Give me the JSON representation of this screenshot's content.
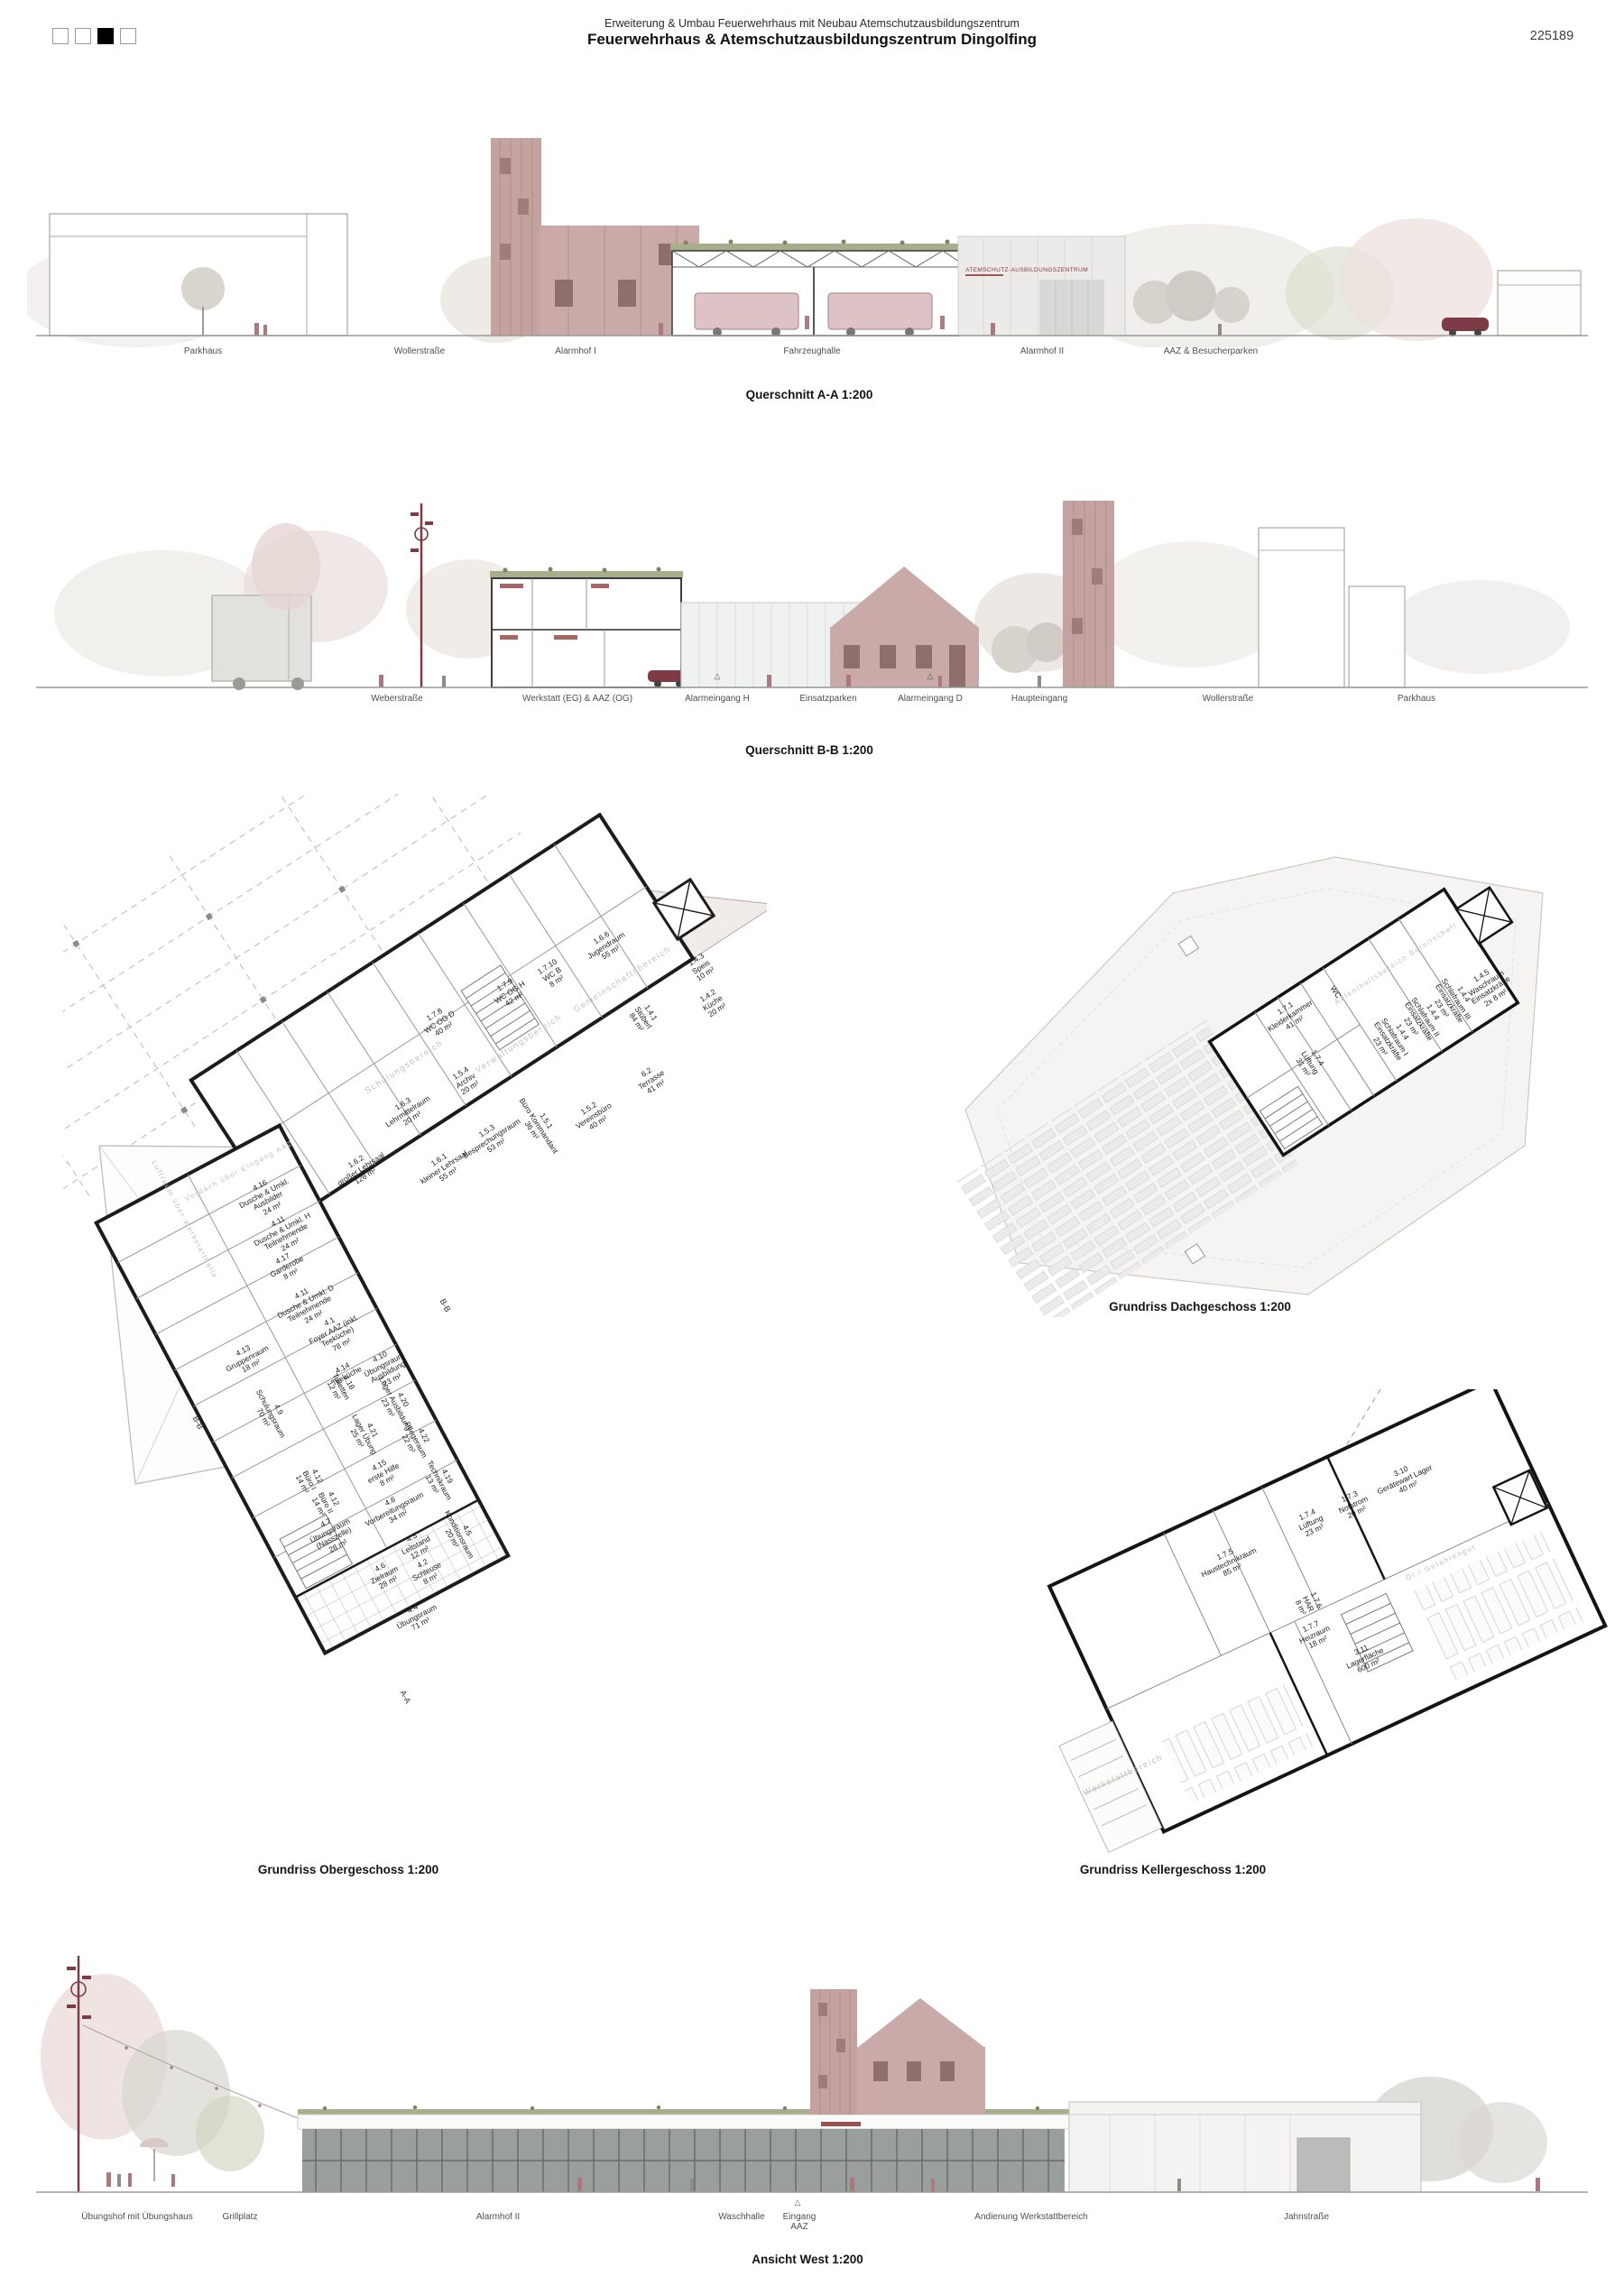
{
  "header": {
    "project_line": "Erweiterung & Umbau Feuerwehrhaus mit Neubau Atemschutzausbildungszentrum",
    "title": "Feuerwehrhaus & Atemschutzausbildungszentrum Dingolfing",
    "sheet_number": "225189",
    "page_indicator": {
      "count": 4,
      "active_index": 3
    }
  },
  "colors": {
    "rose_facade": "#c5a5a3",
    "rose_building": "#c9aaa8",
    "sign_red": "#8a3233",
    "car_red": "#7d3c45",
    "tree_gray": "#d6d3cd",
    "tree_green": "#cfd4c0",
    "wall_black": "#1c1c1c"
  },
  "section_aa": {
    "caption": "Querschnitt A-A 1:200",
    "facade_sign": "ATEMSCHUTZ-AUSBILDUNGSZENTRUM",
    "ground_labels": [
      "Parkhaus",
      "Wollerstraße",
      "Alarmhof I",
      "Fahrzeughalle",
      "Alarmhof II",
      "AAZ & Besucherparken"
    ]
  },
  "section_bb": {
    "caption": "Querschnitt B-B 1:200",
    "ground_labels": [
      "Weberstraße",
      "Werkstatt (EG) & AAZ (OG)",
      "Alarmeingang H",
      "Einsatzparken",
      "Alarmeingang D",
      "Haupteingang",
      "Wollerstraße",
      "Parkhaus"
    ]
  },
  "plan_og": {
    "caption": "Grundriss Obergeschoss 1:200",
    "zones": [
      "Gemeinschaftsbereich",
      "Verwaltungsbereich",
      "Schulungsbereich",
      "Vordach über Eingang AAZ",
      "Luftraum über Werkstatthalle"
    ],
    "markers": {
      "bb": "B-B",
      "aa": "A-A"
    },
    "rooms": [
      {
        "num": "1.6.6",
        "name": "Jugendraum",
        "area": "55 m²"
      },
      {
        "num": "1.7.9",
        "name": "WC OG H",
        "area": "42 m²"
      },
      {
        "num": "1.7.10",
        "name": "WC B",
        "area": "8 m²"
      },
      {
        "num": "1.7.8",
        "name": "WC OG D",
        "area": "40 m²"
      },
      {
        "num": "1.4.3",
        "name": "Speis",
        "area": "10 m²"
      },
      {
        "num": "1.4.2",
        "name": "Küche",
        "area": "20 m²"
      },
      {
        "num": "1.4.1",
        "name": "Stüberl",
        "area": "84 m²"
      },
      {
        "num": "6.2",
        "name": "Terrasse",
        "area": "41 m²"
      },
      {
        "num": "1.5.4",
        "name": "Archiv",
        "area": "20 m²"
      },
      {
        "num": "1.6.3",
        "name": "Lehrmittelraum",
        "area": "20 m²"
      },
      {
        "num": "1.5.3",
        "name": "Besprechungsraum",
        "area": "53 m²"
      },
      {
        "num": "1.5.1",
        "name": "Büro Kommandant",
        "area": "36 m²"
      },
      {
        "num": "1.5.2",
        "name": "Vereinsbüro",
        "area": "40 m²"
      },
      {
        "num": "1.6.2",
        "name": "großer Lehrsaal",
        "area": "128 m²"
      },
      {
        "num": "1.6.1",
        "name": "kleiner Lehrsaal",
        "area": "55 m²"
      },
      {
        "num": "4.16",
        "name": "Dusche & Umkl. Ausbilder",
        "area": "24 m²"
      },
      {
        "num": "4.11",
        "name": "Dusche & Umkl. H Teilnehmende",
        "area": "24 m²"
      },
      {
        "num": "4.17",
        "name": "Garderobe",
        "area": "8 m²"
      },
      {
        "num": "4.11",
        "name": "Dusche & Umkl. D Teilnehmende",
        "area": "24 m²"
      },
      {
        "num": "4.1",
        "name": "Foyer AAZ (inkl. Teeküche)",
        "area": "78 m²"
      },
      {
        "num": "4.13",
        "name": "Gruppenraum",
        "area": "18 m²"
      },
      {
        "num": "4.14",
        "name": "Teeküche",
        "area": ""
      },
      {
        "num": "4.10",
        "name": "Übungsraum Ausbildung",
        "area": "23 m²"
      },
      {
        "num": "4.18",
        "name": "Toiletten",
        "area": "12 m²"
      },
      {
        "num": "4.9",
        "name": "Schulungsraum",
        "area": "70 m²"
      },
      {
        "num": "4.20",
        "name": "Lager Ausbildung",
        "area": "23 m²"
      },
      {
        "num": "4.21",
        "name": "Lager Übung",
        "area": "25 m²"
      },
      {
        "num": "4.22",
        "name": "Pflegeraum",
        "area": "22 m²"
      },
      {
        "num": "4.15",
        "name": "erste Hilfe",
        "area": "8 m²"
      },
      {
        "num": "4.19",
        "name": "Technikraum",
        "area": "13 m²"
      },
      {
        "num": "4.12",
        "name": "Büro I",
        "area": "14 m²"
      },
      {
        "num": "4.12",
        "name": "Büro II",
        "area": "14 m²"
      },
      {
        "num": "4.8",
        "name": "Vorbereitungsraum",
        "area": "34 m²"
      },
      {
        "num": "4.7",
        "name": "Übungsraum (Nasszelle)",
        "area": "28 m²"
      },
      {
        "num": "4.5",
        "name": "Konditionsraum",
        "area": "20 m²"
      },
      {
        "num": "4.3",
        "name": "Leitstand",
        "area": "12 m²"
      },
      {
        "num": "4.2",
        "name": "Schleuse",
        "area": "8 m²"
      },
      {
        "num": "4.6",
        "name": "Zielraum",
        "area": "28 m²"
      },
      {
        "num": "4.4",
        "name": "Übungsraum",
        "area": "71 m²"
      }
    ]
  },
  "plan_dg": {
    "caption": "Grundriss Dachgeschoss 1:200",
    "zones": [
      "Aufenthaltsbereich Bereitschaft"
    ],
    "rooms": [
      {
        "num": "1.7.1",
        "name": "Kleiderkammer",
        "area": "41 m²"
      },
      {
        "num": "1.7.4",
        "name": "Lüftung",
        "area": "31 m²"
      },
      {
        "num": "",
        "name": "WC",
        "area": ""
      },
      {
        "num": "1.4.4",
        "name": "Schlafraum I Einsatzkräfte",
        "area": "23 m²"
      },
      {
        "num": "1.4.4",
        "name": "Schlafraum II Einsatzkräfte",
        "area": "23 m²"
      },
      {
        "num": "1.4.4",
        "name": "Schlafraum III Einsatzkräfte",
        "area": "23 m²"
      },
      {
        "num": "1.4.5",
        "name": "Waschraum Einsatzkräfte",
        "area": "2x 8 m²"
      }
    ]
  },
  "plan_kg": {
    "caption": "Grundriss Kellergeschoss 1:200",
    "zones": [
      "Öl / Gefahrengut",
      "Werkstattbereich"
    ],
    "rooms": [
      {
        "num": "3.10",
        "name": "Gerätewart Lager",
        "area": "40 m²"
      },
      {
        "num": "1.7.3",
        "name": "Notstrom",
        "area": "20 m²"
      },
      {
        "num": "1.7.4",
        "name": "Lüftung",
        "area": "23 m²"
      },
      {
        "num": "1.7.5",
        "name": "Haustechnikraum",
        "area": "85 m²"
      },
      {
        "num": "1.7.6",
        "name": "HAR",
        "area": "8 m²"
      },
      {
        "num": "1.7.7",
        "name": "Heizraum",
        "area": "18 m²"
      },
      {
        "num": "3.11",
        "name": "Lagerfläche",
        "area": "600 m²"
      }
    ]
  },
  "elevation_west": {
    "caption": "Ansicht West 1:200",
    "ground_labels": [
      "Übungshof mit Übungshaus",
      "Grillplatz",
      "Alarmhof II",
      "Waschhalle",
      "Eingang AAZ",
      "Andienung Werkstattbereich",
      "Jahnstraße"
    ]
  }
}
